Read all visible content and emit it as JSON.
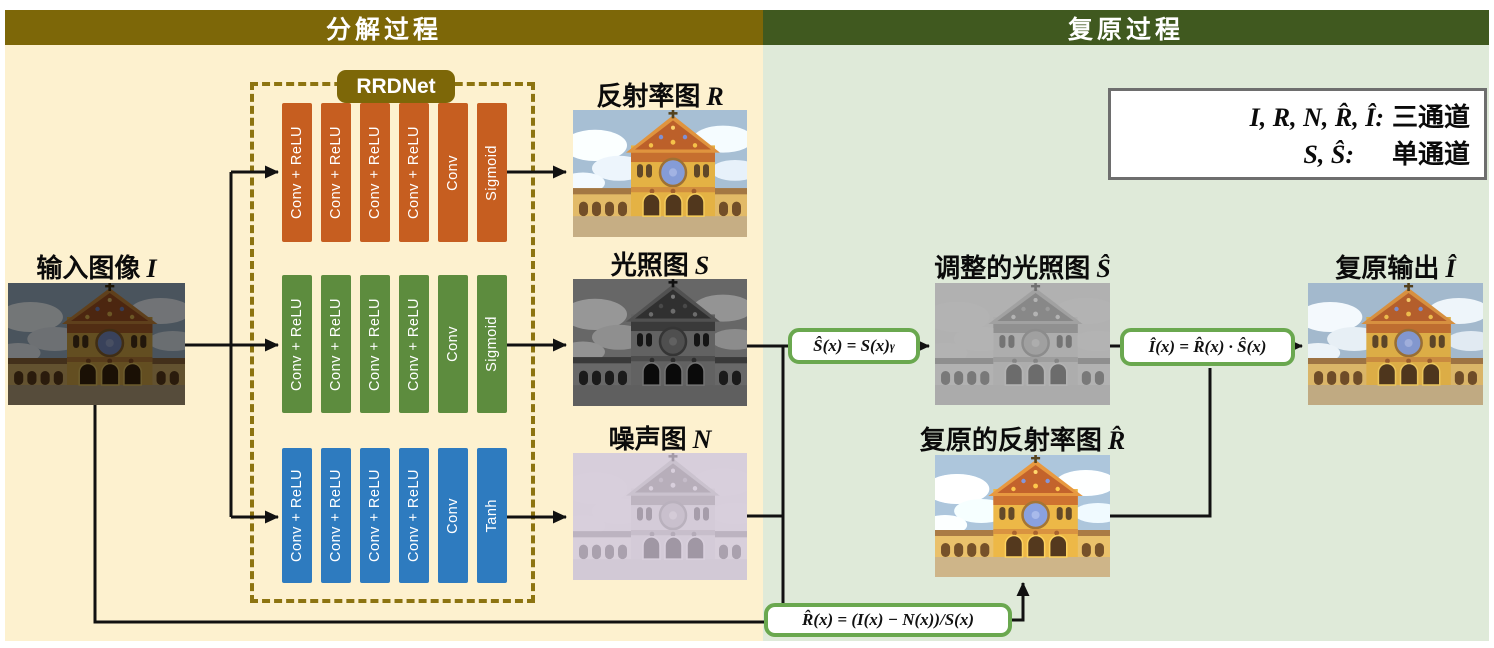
{
  "header": {
    "left": "分解过程",
    "right": "复原过程"
  },
  "rrdnet": {
    "label": "RRDNet"
  },
  "branches": [
    {
      "name": "reflectance-branch",
      "blocks": [
        "Conv + ReLU",
        "Conv + ReLU",
        "Conv + ReLU",
        "Conv + ReLU",
        "Conv",
        "Sigmoid"
      ]
    },
    {
      "name": "illumination-branch",
      "blocks": [
        "Conv + ReLU",
        "Conv + ReLU",
        "Conv + ReLU",
        "Conv + ReLU",
        "Conv",
        "Sigmoid"
      ]
    },
    {
      "name": "noise-branch",
      "blocks": [
        "Conv + ReLU",
        "Conv + ReLU",
        "Conv + ReLU",
        "Conv + ReLU",
        "Conv",
        "Tanh"
      ]
    }
  ],
  "labels": {
    "input": {
      "text": "输入图像",
      "symbol": "I"
    },
    "reflectance": {
      "text": "反射率图",
      "symbol": "R"
    },
    "illumination": {
      "text": "光照图",
      "symbol": "S"
    },
    "noise": {
      "text": "噪声图",
      "symbol": "N"
    },
    "adjusted_illumination": {
      "text": "调整的光照图",
      "symbol": "Ŝ"
    },
    "restored_reflectance": {
      "text": "复原的反射率图",
      "symbol": "R̂"
    },
    "restored_output": {
      "text": "复原输出",
      "symbol": "Î"
    }
  },
  "formulas": {
    "gamma_correction": {
      "base": "Ŝ(x) = S(x)",
      "sup": "γ"
    },
    "restoration": {
      "text": "Î(x) = R̂(x) · Ŝ(x)"
    },
    "reflectance_recovery": {
      "text": "R̂(x) = (I(x) − N(x))/S(x)"
    }
  },
  "legend": {
    "lines": [
      {
        "symbols": "I, R, N, R̂, Î:",
        "label": "三通道"
      },
      {
        "symbols": "S, Ŝ:",
        "label": "单通道"
      }
    ]
  },
  "colors": {
    "left_header_bg": "#7d6708",
    "right_header_bg": "#40591f",
    "left_panel_bg": "#fdf1cf",
    "right_panel_bg": "#dfead9",
    "reflectance_branch": "#c65e20",
    "illumination_branch": "#5d8c3e",
    "noise_branch": "#2e7bbf",
    "formula_border": "#6aa84f",
    "dashed_box_border": "#8d7410"
  }
}
